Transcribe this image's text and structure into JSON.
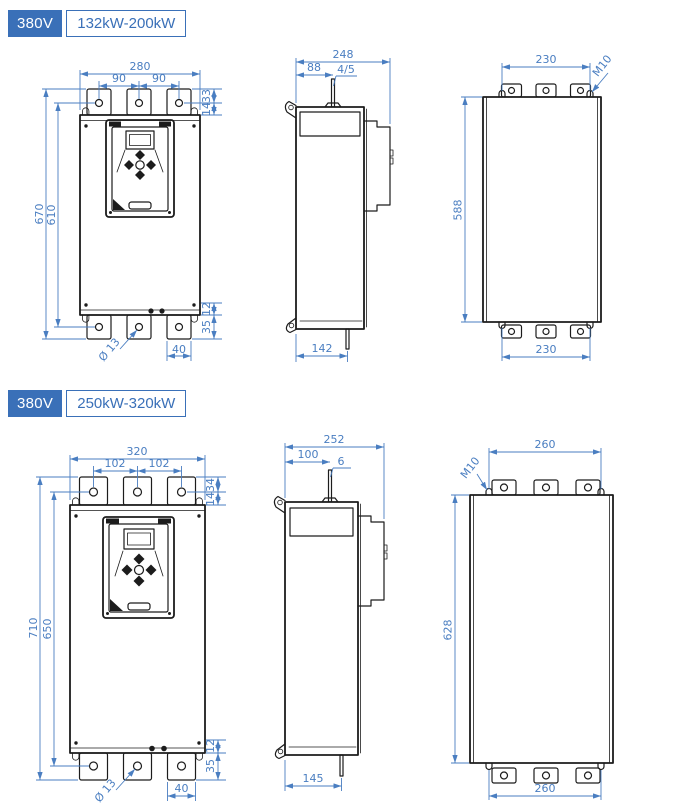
{
  "colors": {
    "header_bg": "#3a70b8",
    "dim": "#4a7ec1",
    "line": "#1c1c1c",
    "page_bg": "#ffffff"
  },
  "sections": [
    {
      "voltage": "380V",
      "power_range": "132kW-200kW",
      "front": {
        "total_width": "280",
        "pitch_left": "90",
        "pitch_right": "90",
        "tab_height": "33",
        "top_offset": "14",
        "total_height": "670",
        "mount_height": "610",
        "bottom_offset": "12",
        "bottom_tab": "35",
        "foot_width": "40",
        "hole_dia": "Ø 13"
      },
      "side": {
        "total_depth": "248",
        "stud_pos": "88",
        "stud_size": "4/5",
        "base_depth": "142"
      },
      "back": {
        "top_pitch": "230",
        "thread": "M10",
        "mount_height": "588",
        "bottom_pitch": "230"
      }
    },
    {
      "voltage": "380V",
      "power_range": "250kW-320kW",
      "front": {
        "total_width": "320",
        "pitch_left": "102",
        "pitch_right": "102",
        "tab_height": "34",
        "top_offset": "14",
        "total_height": "710",
        "mount_height": "650",
        "bottom_offset": "12",
        "bottom_tab": "35",
        "foot_width": "40",
        "hole_dia": "Ø 13"
      },
      "side": {
        "total_depth": "252",
        "stud_pos": "100",
        "stud_size": "6",
        "base_depth": "145"
      },
      "back": {
        "top_pitch": "260",
        "thread": "M10",
        "mount_height": "628",
        "bottom_pitch": "260"
      }
    }
  ]
}
